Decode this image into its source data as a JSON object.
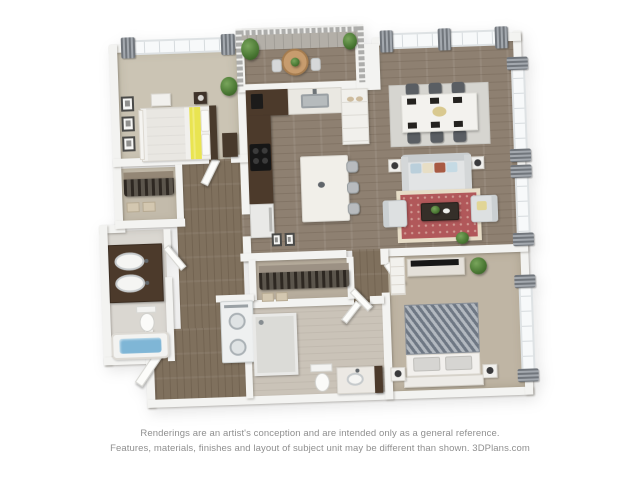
{
  "page": {
    "background": "#ffffff",
    "type": "3d-floor-plan-rendering"
  },
  "disclaimer": {
    "line1": "Renderings are an artist's conception and are intended only as a general reference.",
    "line2": "Features, materials, finishes and layout of subject unit may be different than shown. 3DPlans.com",
    "brand": "3DPlans.com"
  },
  "floor_plan": {
    "view": "top-down 3d rendering, slightly rotated",
    "rooms": [
      {
        "id": "bedroom-1",
        "items": [
          "bed-with-yellow-accent-band",
          "dark-headboard",
          "nightstand-with-lamp",
          "dresser",
          "wall-art-three-frames",
          "potted-plant",
          "window-with-gray-curtains"
        ]
      },
      {
        "id": "closet-1",
        "items": [
          "hanging-clothes",
          "storage-boxes"
        ]
      },
      {
        "id": "bathroom-1",
        "items": [
          "dark-double-sink-vanity",
          "toilet",
          "bathtub-with-blue-water"
        ]
      },
      {
        "id": "laundry",
        "items": [
          "stacked-washer-dryer"
        ]
      },
      {
        "id": "kitchen",
        "items": [
          "dark-l-shaped-counter",
          "sink",
          "coffee-maker",
          "black-cooktop",
          "refrigerator",
          "white-pantry-cabinet",
          "island-with-three-stools"
        ]
      },
      {
        "id": "balcony",
        "items": [
          "railing",
          "round-wood-table",
          "two-chairs",
          "potted-plants"
        ]
      },
      {
        "id": "dining-area",
        "items": [
          "white-table",
          "six-dark-chairs",
          "black-placemats",
          "gray-area-rug",
          "windows-with-gray-curtains"
        ]
      },
      {
        "id": "living-area",
        "items": [
          "light-gray-sofa-with-pillows",
          "two-armchairs",
          "red-oriental-rug",
          "dark-coffee-table-with-plants",
          "side-tables-with-lamps",
          "leaning-art-frames",
          "floor-plant"
        ]
      },
      {
        "id": "walk-in-closet",
        "items": [
          "hanging-clothes",
          "storage-boxes"
        ]
      },
      {
        "id": "bathroom-2",
        "items": [
          "walk-in-shower",
          "toilet",
          "vanity-with-dark-side"
        ]
      },
      {
        "id": "bedroom-2",
        "items": [
          "bed-gray-striped-duvet",
          "two-nightstands-with-lamps",
          "dresser-with-tv",
          "shelf-unit",
          "potted-plant",
          "window-with-gray-curtains"
        ]
      },
      {
        "id": "entry",
        "items": [
          "open-door",
          "wood-floor-hall"
        ]
      }
    ],
    "palette": {
      "wall": "#f3f3f1",
      "wood_floor": "#8e8071",
      "hall_wood": "#7f705d",
      "balcony_deck": "#b3afa8",
      "carpet_bedroom1": "#cbc4b4",
      "carpet_bedroom2": "#bfb5a4",
      "cabinet_dark_brown": "#4c3a2b",
      "accent_yellow_bedding": "#e9e451",
      "rug_red": "#b1585a",
      "rug_red_border": "#e7ddc7",
      "rug_dining_gray": "#d6d5d0",
      "tub_water_blue": "#7fb6d6",
      "curtain_gray": "#71767c",
      "sofa_gray": "#e2e4e5",
      "duvet_stripe_gray": "#6f7884",
      "plant_green": "#4c7a35"
    }
  }
}
